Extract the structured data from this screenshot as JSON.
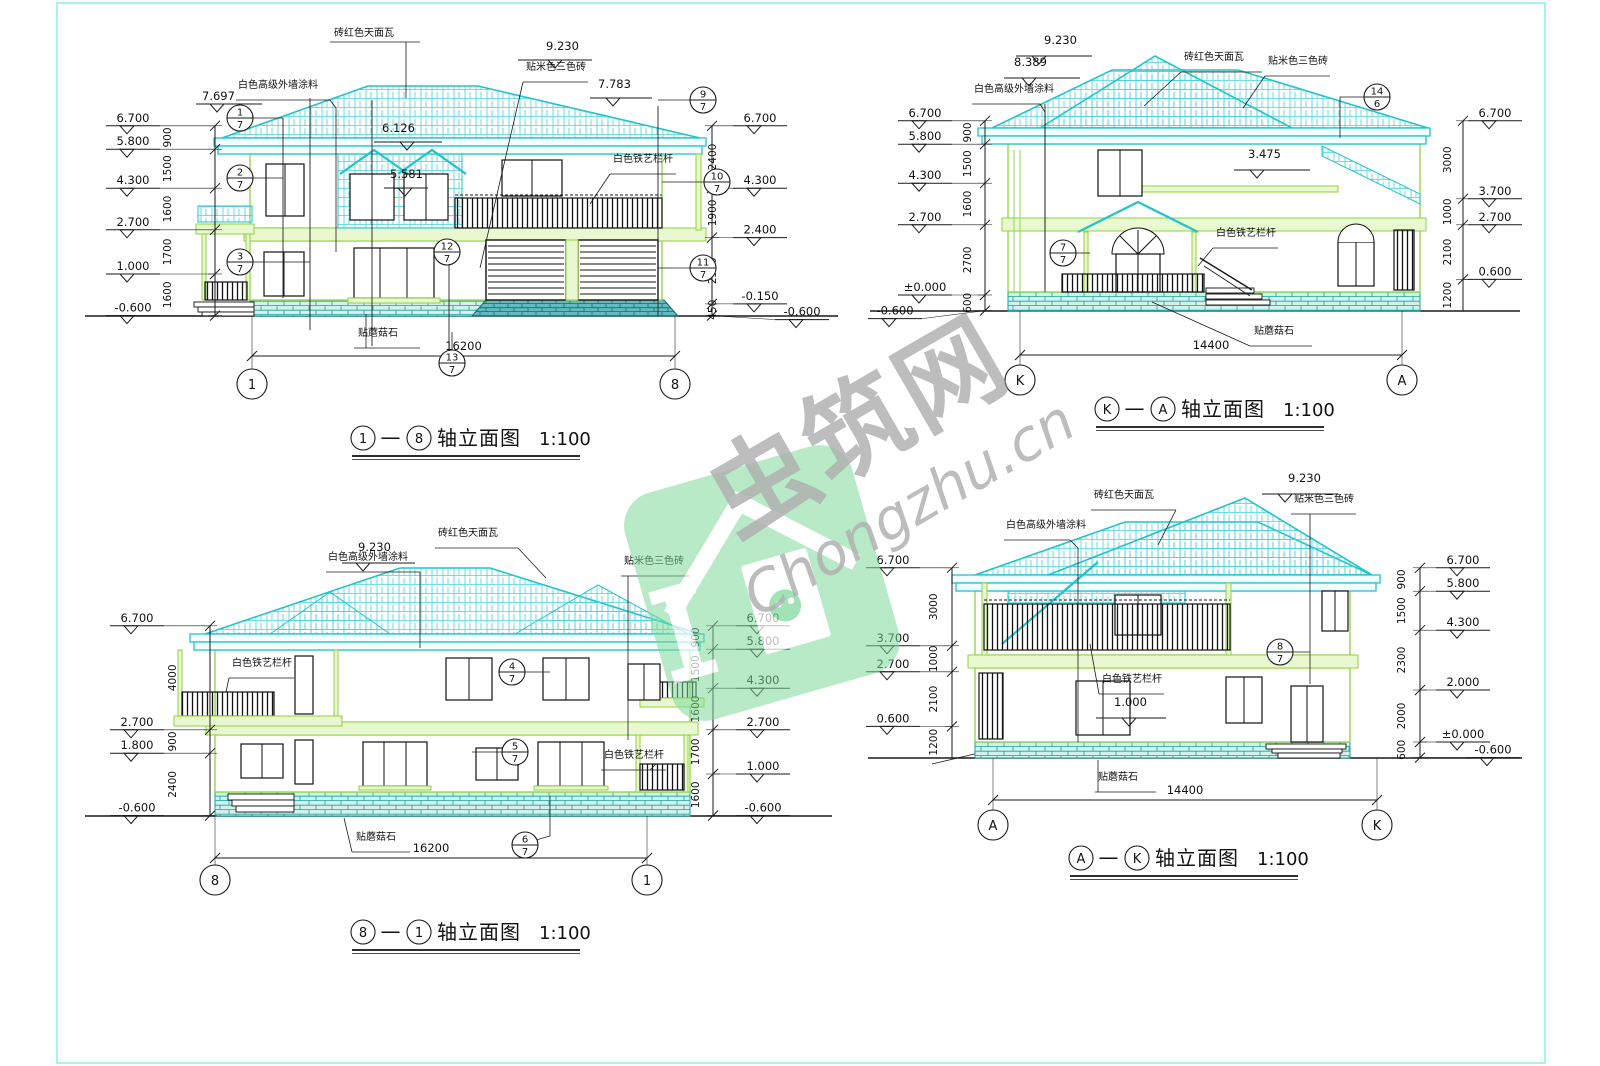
{
  "watermark": {
    "zh": "虫筑网",
    "en": "Chongzhu.cn"
  },
  "materials": {
    "roof_tile": "砖红色天面瓦",
    "wall_paint": "白色高级外墙涂料",
    "beige_brick": "贴米色三色砖",
    "iron_railing": "白色铁艺栏杆",
    "mushroom_stone": "贴蘑菇石"
  },
  "elevations": [
    {
      "name": "front-elevation",
      "title": {
        "from": "1",
        "dash": "—",
        "to": "8",
        "suffix": "轴立面图",
        "scale": "1:100"
      },
      "axes": [
        "1",
        "8"
      ],
      "span": "16200",
      "left": {
        "levels": [
          "6.700",
          "5.800",
          "4.300",
          "2.700",
          "1.000",
          "-0.600"
        ],
        "dims": [
          "900",
          "1500",
          "1600",
          "1700",
          "1600"
        ]
      },
      "right": {
        "levels": [
          "6.700",
          "4.300",
          "2.400",
          "-0.150",
          "-0.600"
        ],
        "dims": [
          "2400",
          "1900",
          "2550",
          "450"
        ]
      },
      "spots": [
        "7.697",
        "9.230",
        "7.783",
        "6.126",
        "5.581"
      ],
      "mats": [
        "roof_tile",
        "wall_paint",
        "beige_brick",
        "iron_railing",
        "mushroom_stone"
      ],
      "bubbles": [
        "1/7",
        "2/7",
        "3/7",
        "9/7",
        "10/7",
        "11/7",
        "12/7",
        "13/7"
      ]
    },
    {
      "name": "left-side-elevation",
      "title": {
        "from": "K",
        "dash": "—",
        "to": "A",
        "suffix": "轴立面图",
        "scale": "1:100"
      },
      "axes": [
        "K",
        "A"
      ],
      "span": "14400",
      "left": {
        "levels": [
          "6.700",
          "5.800",
          "4.300",
          "2.700",
          "±0.000",
          "-0.600"
        ],
        "dims": [
          "900",
          "1500",
          "1600",
          "2700",
          "600"
        ]
      },
      "right": {
        "levels": [
          "6.700",
          "3.700",
          "2.700",
          "0.600"
        ],
        "dims": [
          "3000",
          "1000",
          "2100",
          "1200"
        ]
      },
      "spots": [
        "9.230",
        "8.389",
        "3.475"
      ],
      "mats": [
        "wall_paint",
        "roof_tile",
        "beige_brick",
        "iron_railing",
        "mushroom_stone"
      ],
      "bubbles": [
        "7/7",
        "14/6"
      ]
    },
    {
      "name": "rear-elevation",
      "title": {
        "from": "8",
        "dash": "—",
        "to": "1",
        "suffix": "轴立面图",
        "scale": "1:100"
      },
      "axes": [
        "8",
        "1"
      ],
      "span": "16200",
      "left": {
        "levels": [
          "6.700",
          "2.700",
          "1.800",
          "-0.600"
        ],
        "dims": [
          "4000",
          "900",
          "2400"
        ]
      },
      "right": {
        "levels": [
          "6.700",
          "5.800",
          "4.300",
          "2.700",
          "1.000",
          "-0.600"
        ],
        "dims": [
          "900",
          "1500",
          "1600",
          "1700",
          "1600"
        ]
      },
      "spots": [
        "9.230"
      ],
      "mats": [
        "wall_paint",
        "roof_tile",
        "beige_brick",
        "iron_railing",
        "iron_railing",
        "mushroom_stone"
      ],
      "bubbles": [
        "4/7",
        "5/7",
        "6/7"
      ]
    },
    {
      "name": "right-side-elevation",
      "title": {
        "from": "A",
        "dash": "—",
        "to": "K",
        "suffix": "轴立面图",
        "scale": "1:100"
      },
      "axes": [
        "A",
        "K"
      ],
      "span": "14400",
      "left": {
        "levels": [
          "6.700",
          "3.700",
          "2.700",
          "0.600"
        ],
        "dims": [
          "3000",
          "1000",
          "2100",
          "1200"
        ]
      },
      "right": {
        "levels": [
          "6.700",
          "5.800",
          "4.300",
          "2.000",
          "±0.000",
          "-0.600"
        ],
        "dims": [
          "900",
          "1500",
          "2300",
          "2000",
          "600"
        ]
      },
      "spots": [
        "9.230",
        "1.000"
      ],
      "mats": [
        "wall_paint",
        "roof_tile",
        "beige_brick",
        "iron_railing",
        "mushroom_stone"
      ],
      "bubbles": [
        "8/7"
      ]
    }
  ]
}
